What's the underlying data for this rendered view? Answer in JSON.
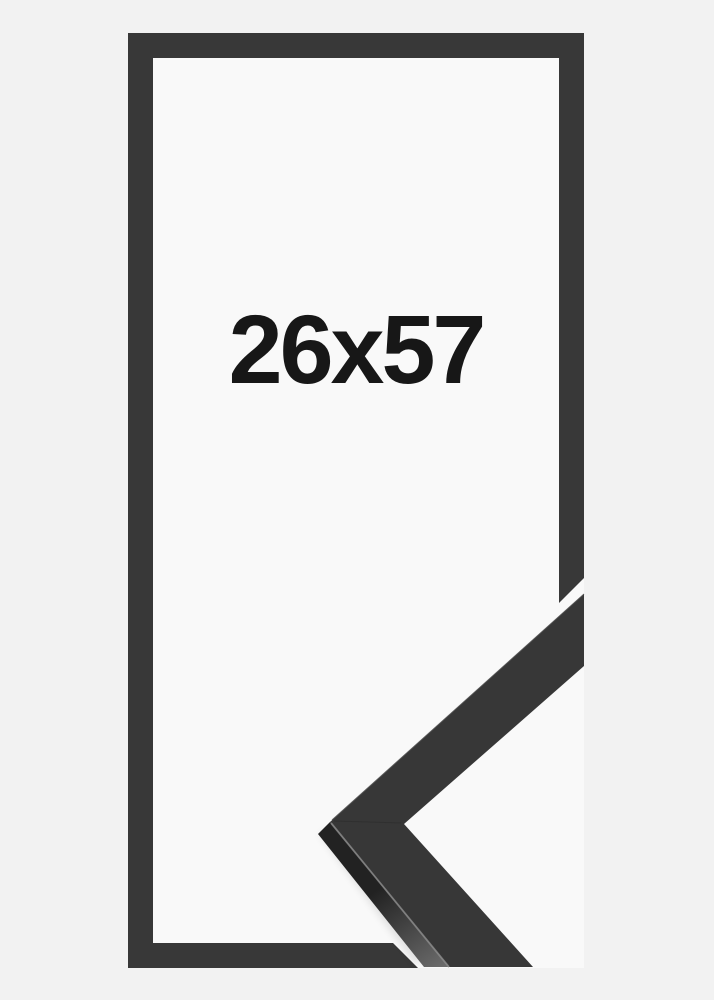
{
  "product_image": {
    "size_label": "26x57",
    "colors": {
      "background": "#f2f2f2",
      "opening": "#f9f9f9",
      "frame": "#383838",
      "sample_face": "#373737",
      "sample_side_dark": "#222222",
      "sample_side_light": "#6b6b6b",
      "sample_edge_highlight": "#8a8a8a",
      "sample_upper_edge": "#4f4f4f",
      "mitre_seam": "#2a2a2a",
      "shadow": "#000000",
      "label": "#171717"
    }
  }
}
